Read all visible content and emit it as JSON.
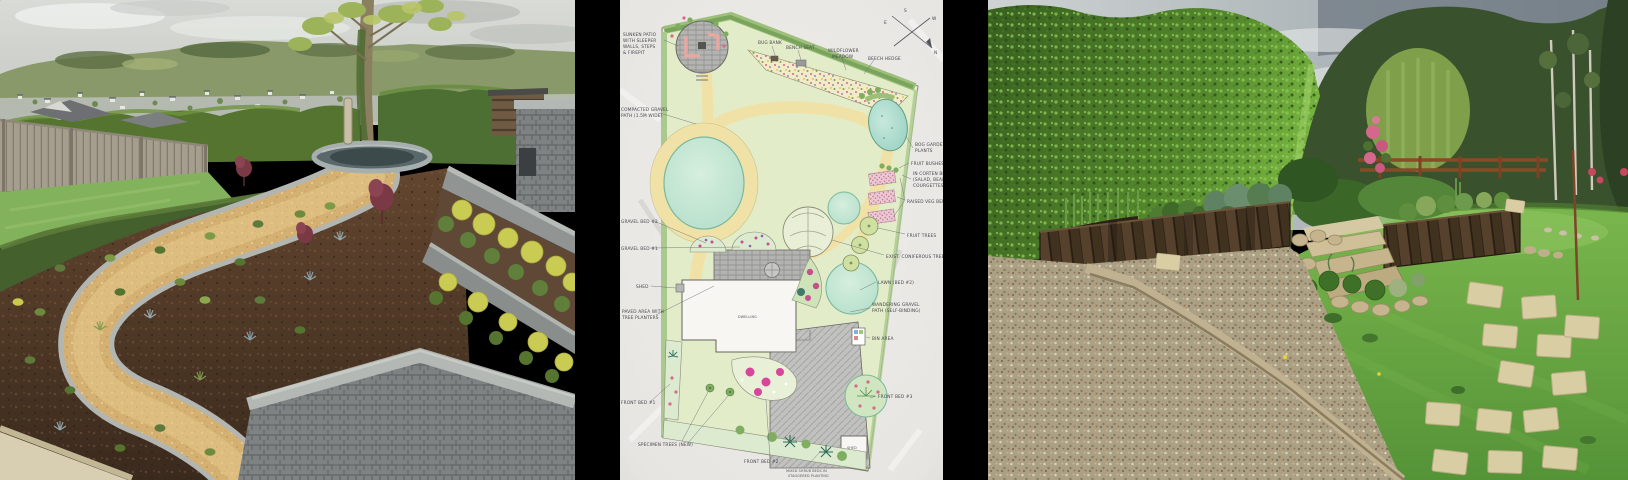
{
  "page": {
    "background": "#000000"
  },
  "gallery": {
    "panels": [
      {
        "id": "photo-terraced-garden",
        "kind": "photograph"
      },
      {
        "id": "garden-design-plan",
        "kind": "hand-drawn-plan"
      },
      {
        "id": "photo-raised-veg-garden",
        "kind": "photograph"
      }
    ]
  },
  "plan": {
    "compass": {
      "n": "N",
      "e": "E",
      "s": "S",
      "w": "W"
    },
    "labels": {
      "sunken1": "SUNKEN PATIO",
      "sunken2": "WITH SLEEPER",
      "sunken3": "WALLS, STEPS",
      "sunken4": "& FIREPIT",
      "path1": "COMPACTED GRAVEL",
      "path2": "PATH (1.5M WIDE)",
      "gravel_bed_2": "GRAVEL BED #2",
      "gravel_bed_1": "GRAVEL BED #1",
      "shed_left": "SHED",
      "paved1": "PAVED AREA WITH",
      "paved2": "TREE PLANTERS",
      "front_bed_1": "FRONT BED #1",
      "new_trees": "SPECIMEN TREES (NEW)",
      "front_bed_2": "FRONT BED #2",
      "note1": "MIXED SHRUB BEDS IN",
      "note2": "STAGGERED PLANTING",
      "dwelling": "DWELLING",
      "shed_box": "SHED",
      "bin_area": "BIN AREA",
      "front_bed_3": "FRONT BED #3",
      "wander1": "WANDERING GRAVEL",
      "wander2": "PATH (SELF-BINDING)",
      "side_lawn": "LAWN (BED #2)",
      "conifer": "EXIST. CONIFEROUS TREE",
      "fruit_trees": "FRUIT TREES",
      "raised_veg": "RAISED VEG BEDS",
      "corten1": "IN CORTEN BEDS",
      "corten2": "(SALAD, BEANS &",
      "corten3": "COURGETTES)",
      "fruit_bushes": "FRUIT BUSHES",
      "bog1": "BOG GARDEN",
      "bog2": "PLANTS",
      "bug_bank": "BUG BANK",
      "bench_seat": "BENCH SEAT",
      "wildflower1": "WILDFLOWER",
      "wildflower2": "MEADOW",
      "beech_hedge": "BEECH HEDGE"
    }
  },
  "colors": {
    "frame_background": "#000000",
    "paper": "#eae8e5",
    "plan_wash": "#e2ebc9",
    "plan_path_yellow": "#f0e2a6",
    "plan_pond_teal": "#a7d8c9",
    "photo_hedge_green": "#5f9335",
    "photo_gravel_tan": "#d4b272",
    "photo_mulch_brown": "#54392a",
    "photo_sleeper_brown": "#4c3828",
    "photo_stone_grey": "#9aa09e"
  }
}
